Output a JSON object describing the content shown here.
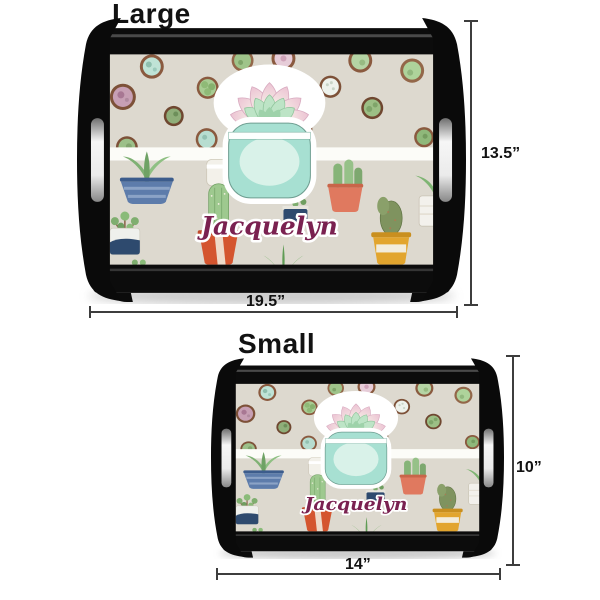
{
  "design": {
    "name": "Jacquelyn",
    "theme": "cactus-succulent-watercolor",
    "colors": {
      "tray_wood": "#0b0b0b",
      "interior_background": "#ddd9cf",
      "center_stripe": "#fcfcf8",
      "jar_teal": "#a7e0d2",
      "name_text": "#7a2150"
    }
  },
  "sizes": [
    {
      "id": "large",
      "label": "Large",
      "height": "13.5”",
      "width": "19.5”"
    },
    {
      "id": "small",
      "label": "Small",
      "height": "10”",
      "width": "14”"
    }
  ]
}
